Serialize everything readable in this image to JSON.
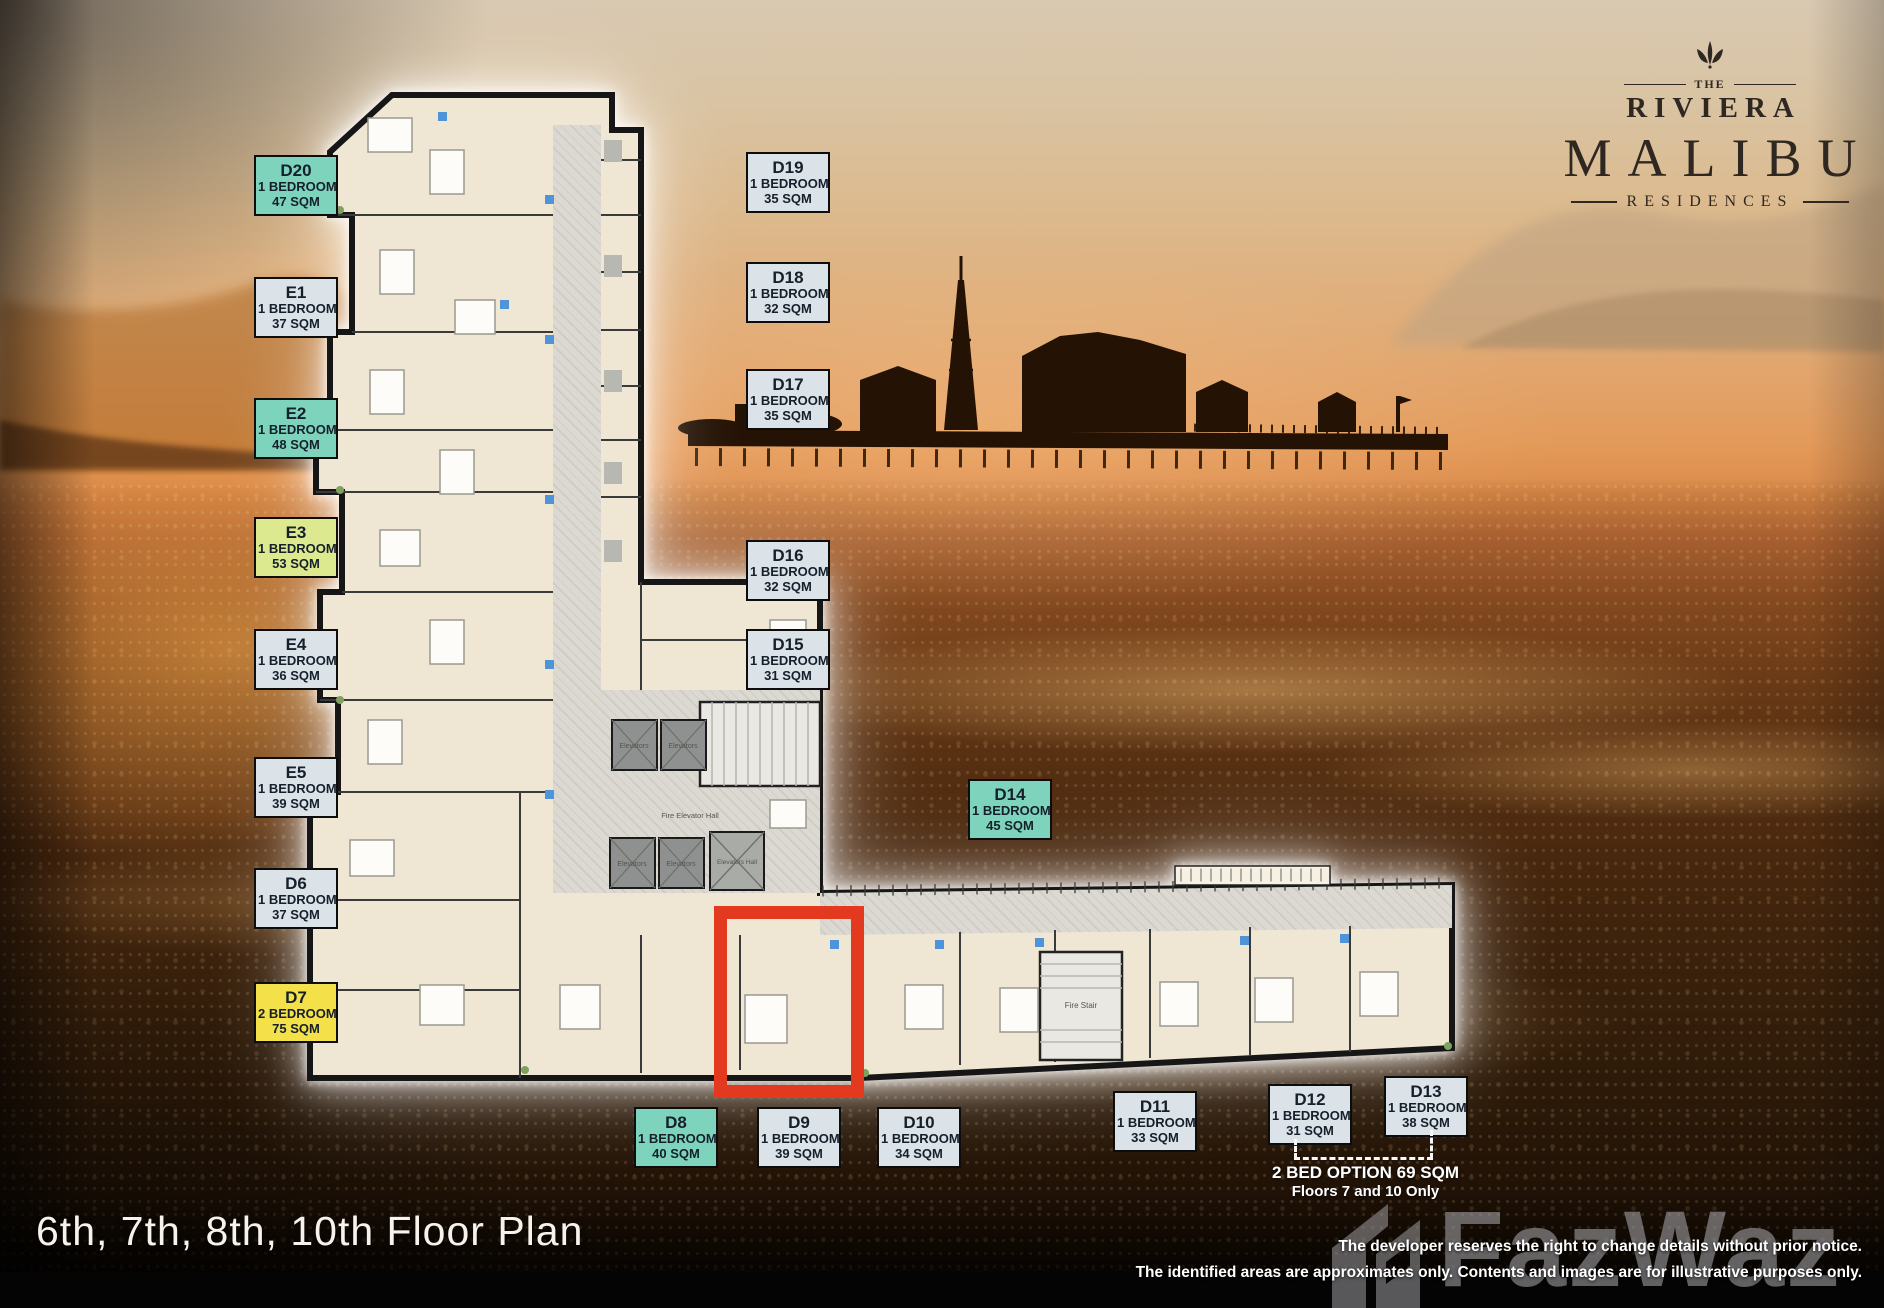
{
  "branding": {
    "the": "THE",
    "name_top": "RIVIERA",
    "name_main": "MALIBU",
    "name_sub": "RESIDENCES"
  },
  "title": "6th, 7th, 8th, 10th Floor Plan",
  "disclaimer": {
    "line1": "The developer reserves the right to change details without prior notice.",
    "line2": "The identified areas are approximates only.  Contents and images are for illustrative purposes only."
  },
  "watermark": "FazWaz",
  "bed_option_note": {
    "line1": "2 BED OPTION  69 SQM",
    "line2": "Floors 7 and 10 Only"
  },
  "plan_labels": {
    "elevators": "Elevators",
    "elevators_hall": "Elevators Hall",
    "fire_elevator_hall": "Fire Elevator Hall",
    "fire_stair": "Fire Stair"
  },
  "palette": {
    "teal": "#7ed3bc",
    "gray": "#dbe2e8",
    "lime": "#dde98f",
    "yellow": "#f4e049",
    "highlight_red": "#e2391f"
  },
  "units": [
    {
      "code": "D20",
      "type": "1 BEDROOM",
      "area": "47 SQM",
      "color": "teal",
      "highlighted": false
    },
    {
      "code": "E1",
      "type": "1 BEDROOM",
      "area": "37 SQM",
      "color": "gray",
      "highlighted": false
    },
    {
      "code": "E2",
      "type": "1 BEDROOM",
      "area": "48 SQM",
      "color": "teal",
      "highlighted": false
    },
    {
      "code": "E3",
      "type": "1 BEDROOM",
      "area": "53 SQM",
      "color": "lime",
      "highlighted": false
    },
    {
      "code": "E4",
      "type": "1 BEDROOM",
      "area": "36 SQM",
      "color": "gray",
      "highlighted": false
    },
    {
      "code": "E5",
      "type": "1 BEDROOM",
      "area": "39 SQM",
      "color": "gray",
      "highlighted": false
    },
    {
      "code": "D6",
      "type": "1 BEDROOM",
      "area": "37 SQM",
      "color": "gray",
      "highlighted": false
    },
    {
      "code": "D7",
      "type": "2 BEDROOM",
      "area": "75 SQM",
      "color": "yellow",
      "highlighted": false
    },
    {
      "code": "D8",
      "type": "1 BEDROOM",
      "area": "40 SQM",
      "color": "teal",
      "highlighted": false
    },
    {
      "code": "D9",
      "type": "1 BEDROOM",
      "area": "39 SQM",
      "color": "gray",
      "highlighted": true
    },
    {
      "code": "D10",
      "type": "1 BEDROOM",
      "area": "34 SQM",
      "color": "gray",
      "highlighted": false
    },
    {
      "code": "D11",
      "type": "1 BEDROOM",
      "area": "33 SQM",
      "color": "gray",
      "highlighted": false
    },
    {
      "code": "D12",
      "type": "1 BEDROOM",
      "area": "31 SQM",
      "color": "gray",
      "highlighted": false
    },
    {
      "code": "D13",
      "type": "1 BEDROOM",
      "area": "38 SQM",
      "color": "gray",
      "highlighted": false
    },
    {
      "code": "D14",
      "type": "1 BEDROOM",
      "area": "45 SQM",
      "color": "teal",
      "highlighted": false
    },
    {
      "code": "D15",
      "type": "1 BEDROOM",
      "area": "31 SQM",
      "color": "gray",
      "highlighted": false
    },
    {
      "code": "D16",
      "type": "1 BEDROOM",
      "area": "32 SQM",
      "color": "gray",
      "highlighted": false
    },
    {
      "code": "D17",
      "type": "1 BEDROOM",
      "area": "35 SQM",
      "color": "gray",
      "highlighted": false
    },
    {
      "code": "D18",
      "type": "1 BEDROOM",
      "area": "32 SQM",
      "color": "gray",
      "highlighted": false
    },
    {
      "code": "D19",
      "type": "1 BEDROOM",
      "area": "35 SQM",
      "color": "gray",
      "highlighted": false
    }
  ]
}
